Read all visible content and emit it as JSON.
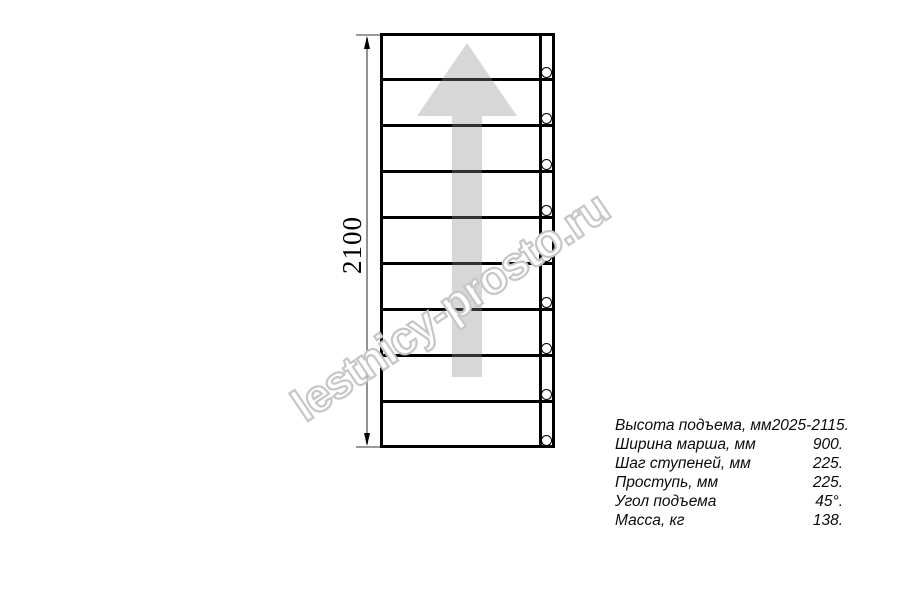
{
  "watermark": {
    "text": "lestnicy-prosto.ru"
  },
  "drawing": {
    "type": "stair-flight-plan-view",
    "dimension_label": "2100",
    "steps_count": 9,
    "arrow_direction": "up"
  },
  "specs": {
    "rows": [
      {
        "label": "Высота подъема, мм",
        "value": "2025-2115."
      },
      {
        "label": "Ширина марша, мм",
        "value": "900."
      },
      {
        "label": "Шаг ступеней, мм",
        "value": "225."
      },
      {
        "label": "Проступь, мм",
        "value": "225."
      },
      {
        "label": "Угол подъема",
        "value": "45°."
      },
      {
        "label": "Масса, кг",
        "value": "138."
      }
    ]
  },
  "colors": {
    "line": "#000000",
    "dimension_line": "#929292",
    "arrow_fill": "#d9d9d9",
    "watermark_outline": "#c6c6c6",
    "background": "#ffffff"
  }
}
